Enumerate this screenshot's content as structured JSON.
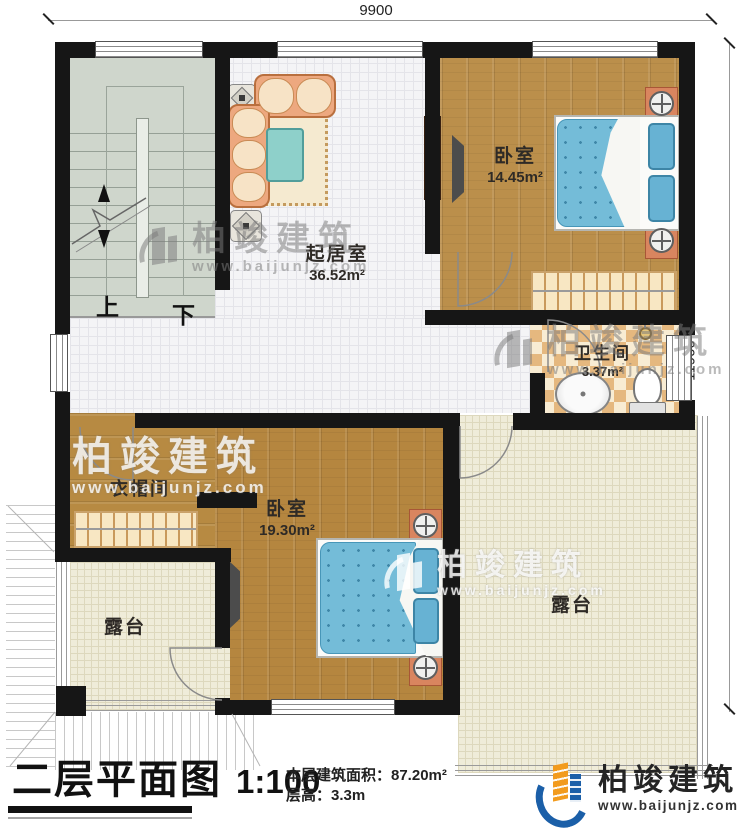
{
  "dimensions": {
    "top": "9900",
    "right": "11900"
  },
  "rooms": {
    "living_room": {
      "name": "起居室",
      "area": "36.52m²"
    },
    "bedroom_top": {
      "name": "卧室",
      "area": "14.45m²"
    },
    "bathroom": {
      "name": "卫生间",
      "area": "3.37m²"
    },
    "cloakroom": {
      "name": "衣帽间"
    },
    "bedroom_bottom": {
      "name": "卧室",
      "area": "19.30m²"
    },
    "terrace_left": {
      "name": "露台"
    },
    "terrace_right": {
      "name": "露台"
    }
  },
  "stairs": {
    "up_label": "上",
    "down_label": "下"
  },
  "watermark": {
    "brand": "柏竣建筑",
    "url": "www.baijunjz.com"
  },
  "footer": {
    "title": "二层平面图",
    "scale": "1:100",
    "area_line": "本层建筑面积：87.20m²",
    "height_line": "层高：3.3m",
    "logo_brand": "柏竣建筑",
    "logo_url": "www.baijunjz.com"
  },
  "colors": {
    "wall": "#161616",
    "wood_floor": "#b5863f",
    "mattress_blue": "#74bcd8",
    "terrace_tile": "#efecd9",
    "bathroom_tile": "#e5b87f",
    "stair_floor": "#cfd6cc",
    "logo_blue": "#1b5fa8",
    "logo_orange": "#f29b1d"
  }
}
